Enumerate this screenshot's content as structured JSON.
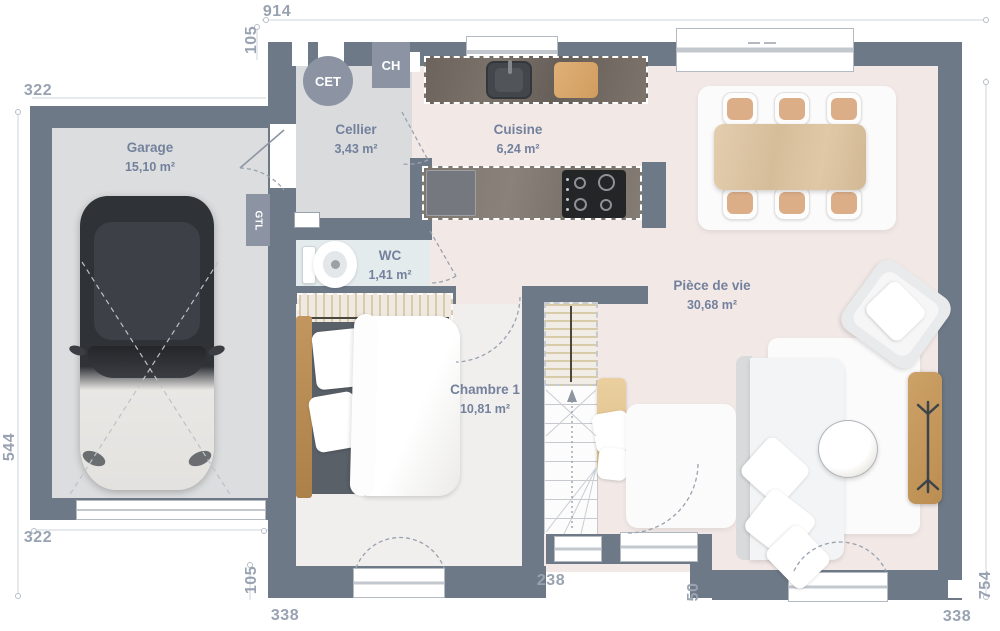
{
  "labels": {
    "garage": {
      "name": "Garage",
      "area": "15,10 m²"
    },
    "cellier": {
      "name": "Cellier",
      "area": "3,43 m²"
    },
    "cuisine": {
      "name": "Cuisine",
      "area": "6,24 m²"
    },
    "wc": {
      "name": "WC",
      "area": "1,41 m²"
    },
    "chambre": {
      "name": "Chambre 1",
      "area": "10,81 m²"
    },
    "piece_de_vie": {
      "name": "Pièce de vie",
      "area": "30,68 m²"
    }
  },
  "equipment": {
    "water_heater": "CET",
    "boiler": "CH",
    "electrical_panel": "GTL"
  },
  "dimensions": {
    "top_width": "914",
    "top_setback": "105",
    "garage_width_top": "322",
    "garage_depth": "544",
    "garage_width_bottom": "322",
    "bottom_left_setback": "105",
    "bedroom_width": "338",
    "stairs_window_width": "238",
    "entry_offset": "50",
    "living_depth": "754",
    "living_width": "338"
  },
  "colors": {
    "wall": "#6e7988",
    "equipment": "#8c94a4",
    "floor_main": "#f2e9e7",
    "floor_garage": "#dcddde",
    "floor_cellier": "#d9dbdd",
    "floor_wc": "#e4ebed",
    "floor_bedroom": "#f0efee",
    "label_text": "#73819c",
    "dimension_text": "#99a2b1",
    "wood": "#d9b07f"
  }
}
